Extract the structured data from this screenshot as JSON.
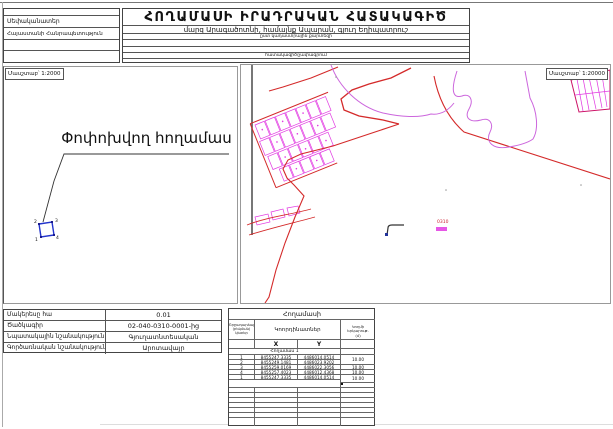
{
  "header": {
    "owner_label": "Սեփականատեր",
    "owner_value": "Հայաստանի Հանրապետություն",
    "title": "ՀՈՂԱՄԱՍԻ ԻՐԱԴՐԱԿԱՆ ՀԱՏԱԿԱԳԻԾ",
    "location": "մարզ Արագածոտնի, համայնք Ապարան, գյուղ Եղիպատրուշ",
    "subline1": "ըստ կադաստրային քարտեզի",
    "subline2": "հատակագիծ/չափագրում"
  },
  "left_map": {
    "scale_label": "Մասշտաբ՝ 1:2000",
    "parcel_label": "Փոփոխվող հողամաս",
    "vertex_labels": [
      "1",
      "2",
      "3",
      "4"
    ]
  },
  "right_map": {
    "scale_label": "Մասշտաբ՝ 1:20000",
    "code_text": "0310"
  },
  "info_table": {
    "rows": [
      {
        "label": "Մակերեսը հա",
        "value": "0.01"
      },
      {
        "label": "Ծածկագիր",
        "value": "02-040-0310-0001-ից"
      },
      {
        "label": "Նպատակային նշանակություն",
        "value": "Գյուղատնտեսական"
      },
      {
        "label": "Գործառնական նշանակություն",
        "value": "Արոտավայր"
      }
    ]
  },
  "coord_table": {
    "title": "Հողամասի",
    "col_point_l1": "Շրջադարձային",
    "col_point_l2": "(բեկման)",
    "col_point_l3": "կետեր",
    "col_coords": "Կոորդինատներ",
    "col_length_l1": "Կողմի երկարութ.",
    "col_length_l2": "(մ)",
    "x_label": "X",
    "y_label": "Y",
    "section": "Հողամաս 1",
    "rows": [
      {
        "n": "1",
        "x": "8455247.3335",
        "y": "4486014.0514"
      },
      {
        "n": "2",
        "x": "8455249.1481",
        "y": "4486023.9202"
      },
      {
        "n": "3",
        "x": "8455259.0169",
        "y": "4486022.3056"
      },
      {
        "n": "4",
        "x": "8455257.4023",
        "y": "4486012.4368"
      },
      {
        "n": "1",
        "x": "8455247.3335",
        "y": "4486014.0514"
      }
    ],
    "lengths": [
      "10.00",
      "10.00",
      "10.00",
      "10.00"
    ]
  },
  "colors": {
    "map_red": "#d42a2a",
    "map_magenta": "#e23ae2",
    "map_violet": "#cc66dd",
    "parcel_blue": "#2233cc"
  }
}
